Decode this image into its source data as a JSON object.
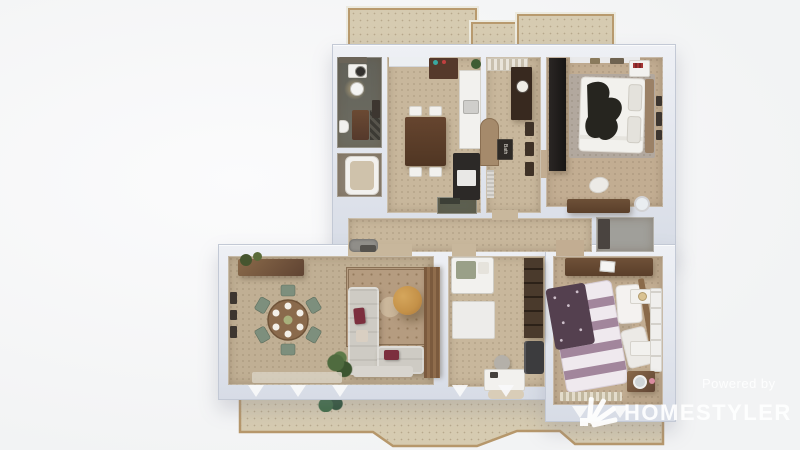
{
  "watermark": {
    "powered_by": "Powered by",
    "brand": "HOMESTYLER",
    "logo": "homestyler-fan-logo"
  },
  "decor": {
    "bath_sign_text": "Bath"
  },
  "rooms": [
    "balcony-top",
    "laundry-bathroom",
    "bathroom-tub",
    "kitchen-dining",
    "entry-hall",
    "bedroom-1",
    "corridor",
    "closet-green",
    "closet-gray",
    "living-dining-room",
    "nursery",
    "bedroom-2",
    "balcony-bottom"
  ],
  "palette": {
    "bg": "#f4f4f5",
    "wall_light": "#eef0f5",
    "wall_dark": "#d7dce6",
    "wall_border": "#c3c9d5",
    "floor_warm": "#c8b79c",
    "floor_living": "#c0af94",
    "floor_bath": "#6e6d62",
    "balcony_floor": "#d6cbb1",
    "balcony_border": "#b89a6e",
    "wood_dark": "#5f4332",
    "wood_mid": "#8a6a4a",
    "sofa_gray": "#cecbc4",
    "accent_burgundy": "#7c2f3e",
    "accent_mustard": "#c49148",
    "chair_green": "#7d8f7d",
    "bed2_purple": "#54404f",
    "dark_wardrobe": "#262220",
    "watermark": "#ffffff"
  }
}
